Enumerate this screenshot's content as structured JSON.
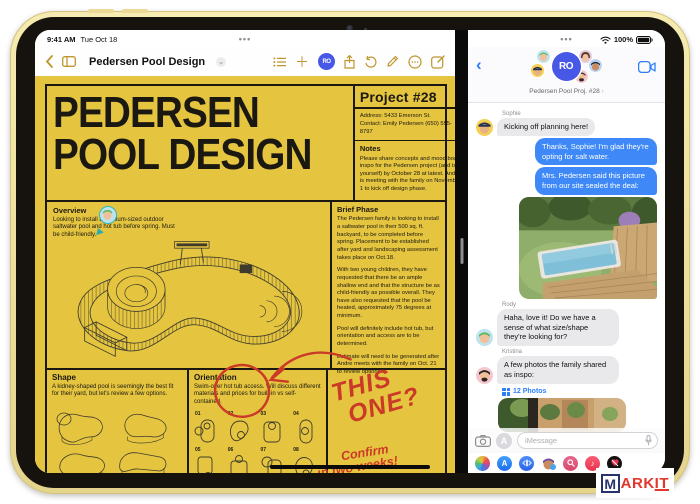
{
  "colors": {
    "flyer_yellow": "#E5C53F",
    "notes_accent": "#BD962F",
    "imessage_blue": "#3E89F7",
    "gray_bubble": "#E9E9EB",
    "link_blue": "#2D7FF9",
    "red_marker": "#CB3A28",
    "device_body": "#F0E4A4"
  },
  "status": {
    "time": "9:41 AM",
    "date": "Tue Oct 18",
    "battery": "100%"
  },
  "notes": {
    "toolbar": {
      "title": "Pedersen Pool Design"
    },
    "flyer": {
      "headline_line1": "PEDERSEN",
      "headline_line2": "POOL DESIGN",
      "project": {
        "title": "Project #28",
        "address": "Address: 5433 Emerson St.",
        "contact": "Contact: Emily Pedersen (650) 555-8797",
        "notes_heading": "Notes",
        "notes_body": "Please share concepts and mood board inspo for the Pedersen project (and tag yourself) by October 28 at latest. Andre is meeting with the family on November 1 to kick off design phase."
      },
      "overview": {
        "heading": "Overview",
        "body": "Looking to install a medium-sized outdoor saltwater pool and hot tub before spring. Must be child-friendly."
      },
      "brief": {
        "heading": "Brief Phase",
        "paragraphs": [
          "The Pedersen family is looking to install a saltwater pool in their 500 sq. ft. backyard, to be completed before spring. Placement to be established after yard and landscaping assessment takes place on Oct.18.",
          "With two young children, they have requested that there be an ample shallow end and that the structure be as child-friendly as possible overall. They have also requested that the pool be heated, approximately 75 degrees at minimum.",
          "Pool will definitely include hot tub, but orientation and access are to be determined.",
          "Estimate will need to be generated after Andre meets with the family on Oct. 21 to review options."
        ]
      },
      "shape": {
        "heading": "Shape",
        "body": "A kidney-shaped pool is seemingly the best fit for their yard, but let's review a few options."
      },
      "orientation": {
        "heading": "Orientation",
        "body": "Swim-over hot tub access. Will discuss different materials and prices for built-in vs self-contained.",
        "numbers": [
          "01",
          "02",
          "03",
          "04",
          "05",
          "06",
          "07",
          "08"
        ]
      },
      "annotations": {
        "line1": "THIS",
        "line2": "ONE?",
        "line3": "Confirm",
        "line4": "in two weeks!"
      }
    }
  },
  "messages": {
    "header": {
      "title": "Pedersen Pool Proj. #28",
      "logo": "RO",
      "chevron": "›"
    },
    "items": [
      {
        "sender": "Sophie",
        "text": "Kicking off planning here!"
      },
      {
        "text": "Thanks, Sophie! I'm glad they're opting for salt water."
      },
      {
        "text": "Mrs. Pedersen said this picture from our site sealed the deal:"
      },
      {
        "sender": "Rody",
        "text": "Haha, love it! Do we have a sense of what size/shape they're looking for?"
      },
      {
        "sender": "Kristina",
        "text": "A few photos the family shared as inspo:"
      }
    ],
    "photos_link": "12 Photos",
    "input_placeholder": "iMessage"
  },
  "watermark": {
    "m": "M",
    "ark": "ARK",
    "it": "IT"
  }
}
